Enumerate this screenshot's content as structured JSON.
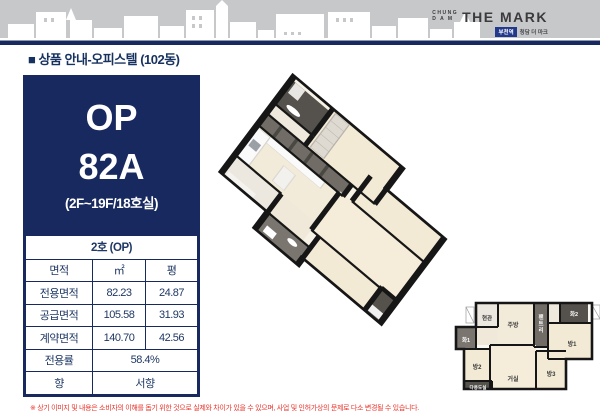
{
  "header": {
    "logo_top1": "CHUNG",
    "logo_top2": "D A M",
    "logo_main": "THE MARK",
    "logo_badge": "부천역",
    "logo_sub": "청담 더 마크",
    "section_title": "■ 상품 안내-오피스텔 (102동)"
  },
  "unit": {
    "type": "OP",
    "name": "82A",
    "floors": "(2F~19F/18호실)"
  },
  "table": {
    "title": "2호 (OP)",
    "col_area": "면적",
    "col_m2": "㎡",
    "col_py": "평",
    "rows": [
      {
        "label": "전용면적",
        "m2": "82.23",
        "py": "24.87"
      },
      {
        "label": "공급면적",
        "m2": "105.58",
        "py": "31.93"
      },
      {
        "label": "계약면적",
        "m2": "140.70",
        "py": "42.56"
      }
    ],
    "ratio_label": "전용률",
    "ratio_value": "58.4%",
    "direction_label": "향",
    "direction_value": "서향"
  },
  "floorplan": {
    "rooms": {
      "entry": "현관",
      "kitchen": "주방",
      "pantry": "팬트리",
      "bath1": "화1",
      "bath2": "화2",
      "room1": "방1",
      "room2": "방2",
      "room3": "방3",
      "living": "거실",
      "utility": "다용도실"
    }
  },
  "footer": {
    "disclaimer": "※ 상기 이미지 및 내용은 소비자의 이해를 돕기 위한 것으로 실제와 차이가 있을 수 있으며, 사업 및 인허가상의 문제로 다소 변경될 수 있습니다."
  },
  "colors": {
    "navy": "#17295e",
    "band_gray": "#c7c8ca",
    "red": "#e8332a",
    "floor": "#f2e9d5",
    "wall": "#161616"
  }
}
